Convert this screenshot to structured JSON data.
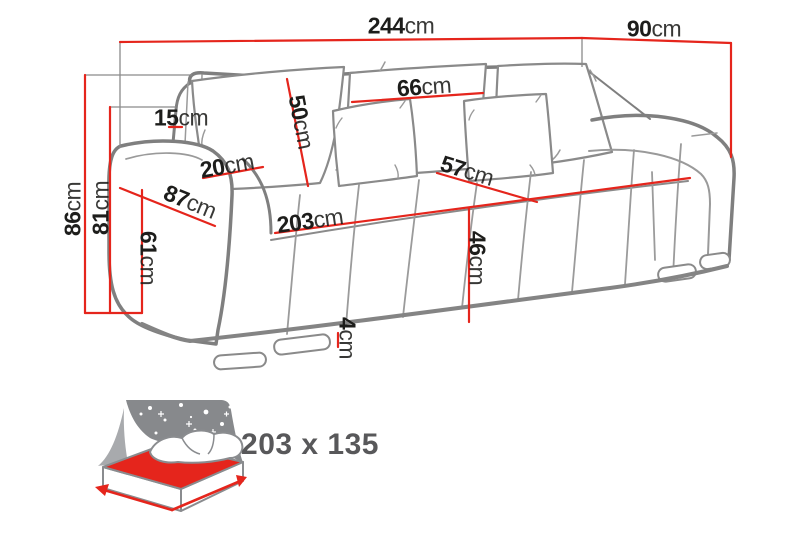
{
  "diagram": {
    "dimensions": {
      "total_width": {
        "value": "244",
        "unit": "cm"
      },
      "total_depth": {
        "value": "90",
        "unit": "cm"
      },
      "total_height": {
        "value": "86",
        "unit": "cm"
      },
      "backrest_height": {
        "value": "81",
        "unit": "cm"
      },
      "wing_depth": {
        "value": "15",
        "unit": "cm"
      },
      "back_cushion_height": {
        "value": "50",
        "unit": "cm"
      },
      "back_pillow_width": {
        "value": "66",
        "unit": "cm"
      },
      "armrest_top_width": {
        "value": "20",
        "unit": "cm"
      },
      "armrest_depth": {
        "value": "87",
        "unit": "cm"
      },
      "seat_width": {
        "value": "203",
        "unit": "cm"
      },
      "armrest_height": {
        "value": "61",
        "unit": "cm"
      },
      "seat_depth": {
        "value": "57",
        "unit": "cm"
      },
      "seat_height": {
        "value": "46",
        "unit": "cm"
      },
      "leg_height": {
        "value": "4",
        "unit": "cm"
      }
    },
    "sleeping_area": {
      "size": "203 x 135"
    },
    "colors": {
      "dimension_line": "#e5251c",
      "outline": "#7f7f7f",
      "label_text": "#1d1d1b",
      "icon_gray": "#87898c",
      "sleeping_text": "#58585a",
      "background": "#ffffff"
    }
  }
}
